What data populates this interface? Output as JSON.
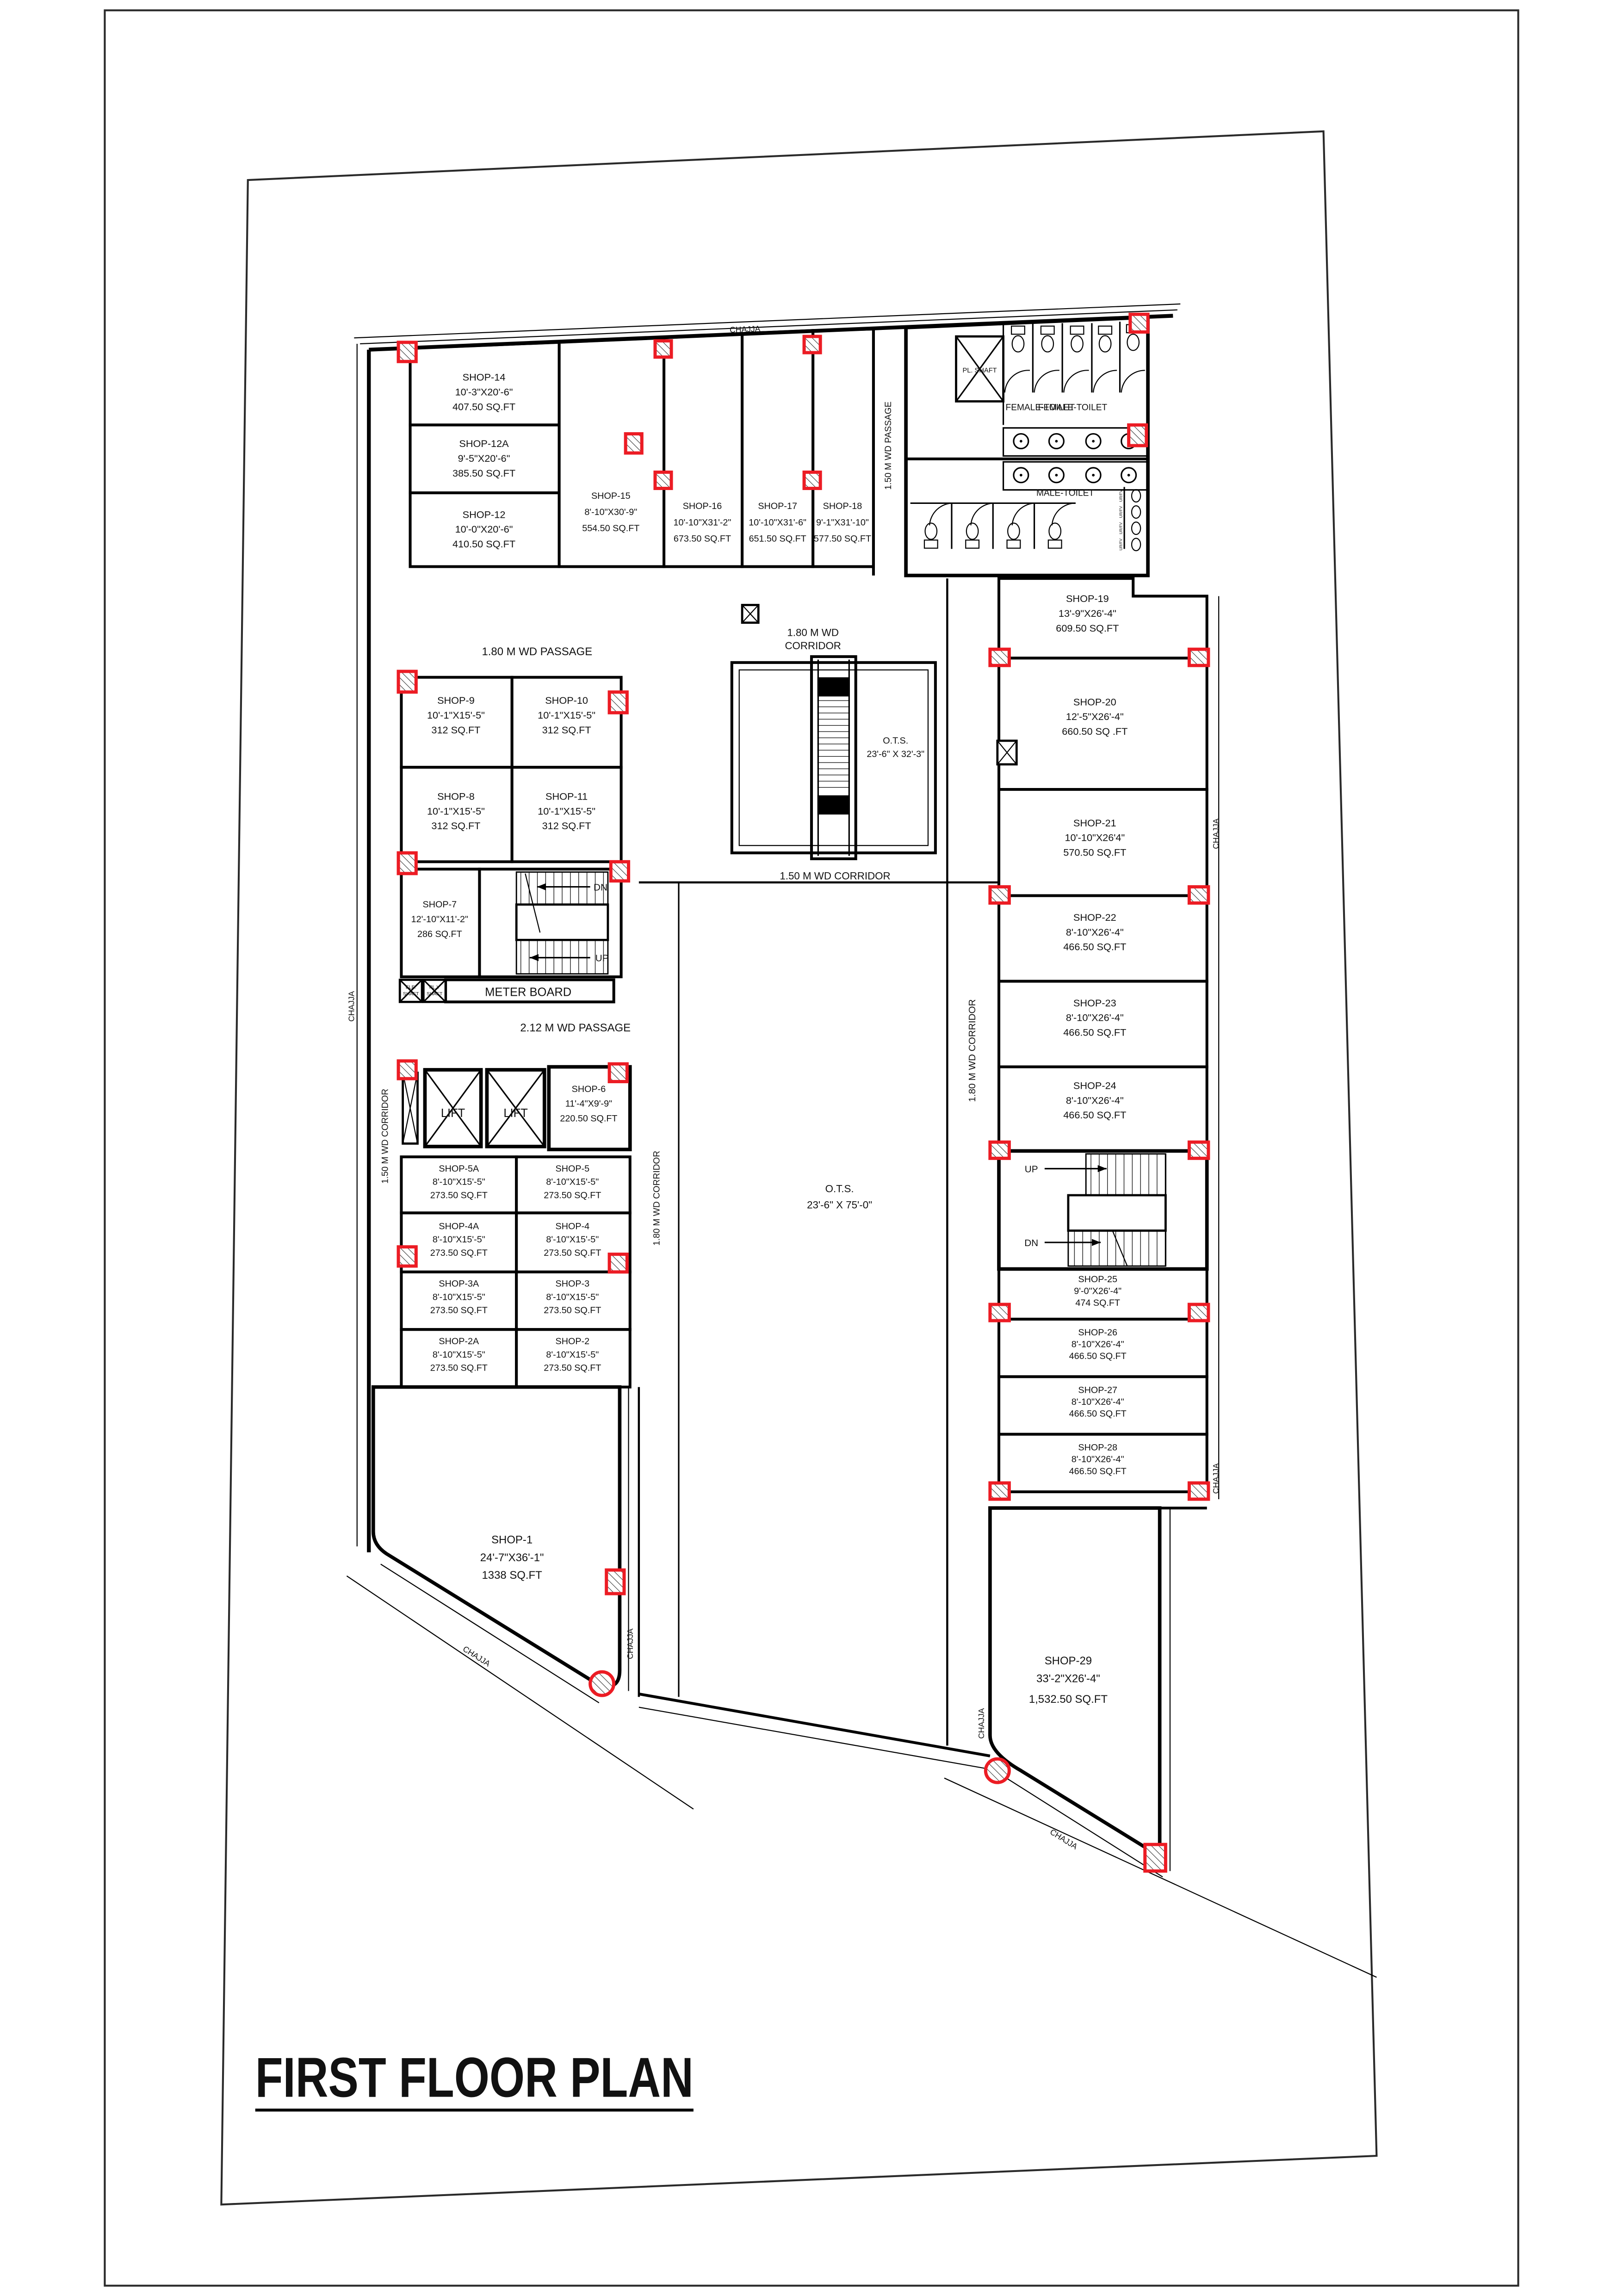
{
  "title": "FIRST FLOOR PLAN",
  "colors": {
    "column_red": "#ec1c24",
    "line": "#000000",
    "paper": "#ffffff"
  },
  "labels": {
    "chajja": "CHAJJA",
    "lift": "LIFT",
    "meter_board": "METER BOARD",
    "pl_shaft": "PL. SHAFT",
    "ele_shaft_l1": "ELE.",
    "ele_shaft_l2": "SHAFT",
    "plv_shaft_l1": "PL.V",
    "plv_shaft_l2": "SHAFT",
    "female_toilet": "FEMALE-TOILET",
    "male_toilet": "MALE-TOILET",
    "ur_fv": "UR/FV",
    "up": "UP",
    "dn": "DN",
    "ots": "O.T.S.",
    "ots_upper_dim": "23'-6\" X 32'-3\"",
    "ots_lower_dim": "23'-6\" X 75'-0\"",
    "corridor_180_l1": "1.80 M WD",
    "corridor_180_l2": "CORRIDOR",
    "corridor_180": "1.80 M WD CORRIDOR",
    "corridor_150": "1.50 M WD CORRIDOR",
    "passage_150": "1.50 M WD PASSAGE",
    "passage_180": "1.80 M WD PASSAGE",
    "passage_212": "2.12 M WD PASSAGE"
  },
  "shops": {
    "s1": {
      "name": "SHOP-1",
      "dim": "24'-7\"X36'-1\"",
      "area": "1338 SQ.FT"
    },
    "s2": {
      "name": "SHOP-2",
      "dim": "8'-10\"X15'-5\"",
      "area": "273.50 SQ.FT"
    },
    "s2a": {
      "name": "SHOP-2A",
      "dim": "8'-10\"X15'-5\"",
      "area": "273.50 SQ.FT"
    },
    "s3": {
      "name": "SHOP-3",
      "dim": "8'-10\"X15'-5\"",
      "area": "273.50 SQ.FT"
    },
    "s3a": {
      "name": "SHOP-3A",
      "dim": "8'-10\"X15'-5\"",
      "area": "273.50 SQ.FT"
    },
    "s4": {
      "name": "SHOP-4",
      "dim": "8'-10\"X15'-5\"",
      "area": "273.50 SQ.FT"
    },
    "s4a": {
      "name": "SHOP-4A",
      "dim": "8'-10\"X15'-5\"",
      "area": "273.50 SQ.FT"
    },
    "s5": {
      "name": "SHOP-5",
      "dim": "8'-10\"X15'-5\"",
      "area": "273.50 SQ.FT"
    },
    "s5a": {
      "name": "SHOP-5A",
      "dim": "8'-10\"X15'-5\"",
      "area": "273.50 SQ.FT"
    },
    "s6": {
      "name": "SHOP-6",
      "dim": "11'-4\"X9'-9\"",
      "area": "220.50 SQ.FT"
    },
    "s7": {
      "name": "SHOP-7",
      "dim": "12'-10\"X11'-2\"",
      "area": "286 SQ.FT"
    },
    "s8": {
      "name": "SHOP-8",
      "dim": "10'-1\"X15'-5\"",
      "area": "312 SQ.FT"
    },
    "s9": {
      "name": "SHOP-9",
      "dim": "10'-1\"X15'-5\"",
      "area": "312 SQ.FT"
    },
    "s10": {
      "name": "SHOP-10",
      "dim": "10'-1\"X15'-5\"",
      "area": "312 SQ.FT"
    },
    "s11": {
      "name": "SHOP-11",
      "dim": "10'-1\"X15'-5\"",
      "area": "312 SQ.FT"
    },
    "s12": {
      "name": "SHOP-12",
      "dim": "10'-0\"X20'-6\"",
      "area": "410.50 SQ.FT"
    },
    "s12a": {
      "name": "SHOP-12A",
      "dim": "9'-5\"X20'-6\"",
      "area": "385.50 SQ.FT"
    },
    "s14": {
      "name": "SHOP-14",
      "dim": "10'-3\"X20'-6\"",
      "area": "407.50 SQ.FT"
    },
    "s15": {
      "name": "SHOP-15",
      "dim": "8'-10\"X30'-9\"",
      "area": "554.50 SQ.FT"
    },
    "s16": {
      "name": "SHOP-16",
      "dim": "10'-10\"X31'-2\"",
      "area": "673.50 SQ.FT"
    },
    "s17": {
      "name": "SHOP-17",
      "dim": "10'-10\"X31'-6\"",
      "area": "651.50 SQ.FT"
    },
    "s18": {
      "name": "SHOP-18",
      "dim": "9'-1\"X31'-10\"",
      "area": "577.50 SQ.FT"
    },
    "s19": {
      "name": "SHOP-19",
      "dim": "13'-9\"X26'-4\"",
      "area": "609.50 SQ.FT"
    },
    "s20": {
      "name": "SHOP-20",
      "dim": "12'-5\"X26'-4\"",
      "area": "660.50 SQ .FT"
    },
    "s21": {
      "name": "SHOP-21",
      "dim": "10'-10\"X26'4\"",
      "area": "570.50 SQ.FT"
    },
    "s22": {
      "name": "SHOP-22",
      "dim": "8'-10\"X26'-4\"",
      "area": "466.50 SQ.FT"
    },
    "s23": {
      "name": "SHOP-23",
      "dim": "8'-10\"X26'-4\"",
      "area": "466.50 SQ.FT"
    },
    "s24": {
      "name": "SHOP-24",
      "dim": "8'-10\"X26'-4\"",
      "area": "466.50 SQ.FT"
    },
    "s25": {
      "name": "SHOP-25",
      "dim": "9'-0\"X26'-4\"",
      "area": "474 SQ.FT"
    },
    "s26": {
      "name": "SHOP-26",
      "dim": "8'-10\"X26'-4\"",
      "area": "466.50 SQ.FT"
    },
    "s27": {
      "name": "SHOP-27",
      "dim": "8'-10\"X26'-4\"",
      "area": "466.50 SQ.FT"
    },
    "s28": {
      "name": "SHOP-28",
      "dim": "8'-10\"X26'-4\"",
      "area": "466.50 SQ.FT"
    },
    "s29": {
      "name": "SHOP-29",
      "dim": "33'-2\"X26'-4\"",
      "area": "1,532.50 SQ.FT"
    }
  }
}
